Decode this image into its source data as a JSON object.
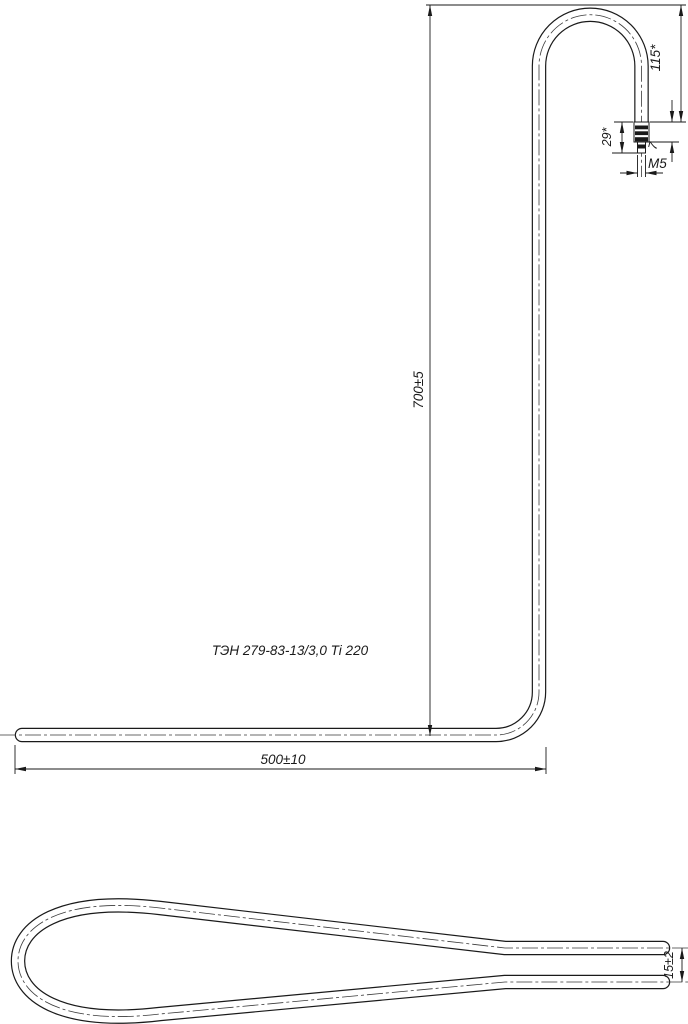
{
  "drawing": {
    "part_label": "ТЭН 279-83-13/3,0 Ti 220",
    "colors": {
      "line": "#1a1a1a",
      "background": "#ffffff"
    },
    "front_view": {
      "dim_total_height": "700±5",
      "dim_total_width": "500±10",
      "dim_hook_drop": "115*",
      "dim_terminal_length": "29*",
      "dim_insulator_length": "7",
      "dim_thread": "M5"
    },
    "top_view": {
      "dim_pin_spacing": "15±2"
    }
  }
}
